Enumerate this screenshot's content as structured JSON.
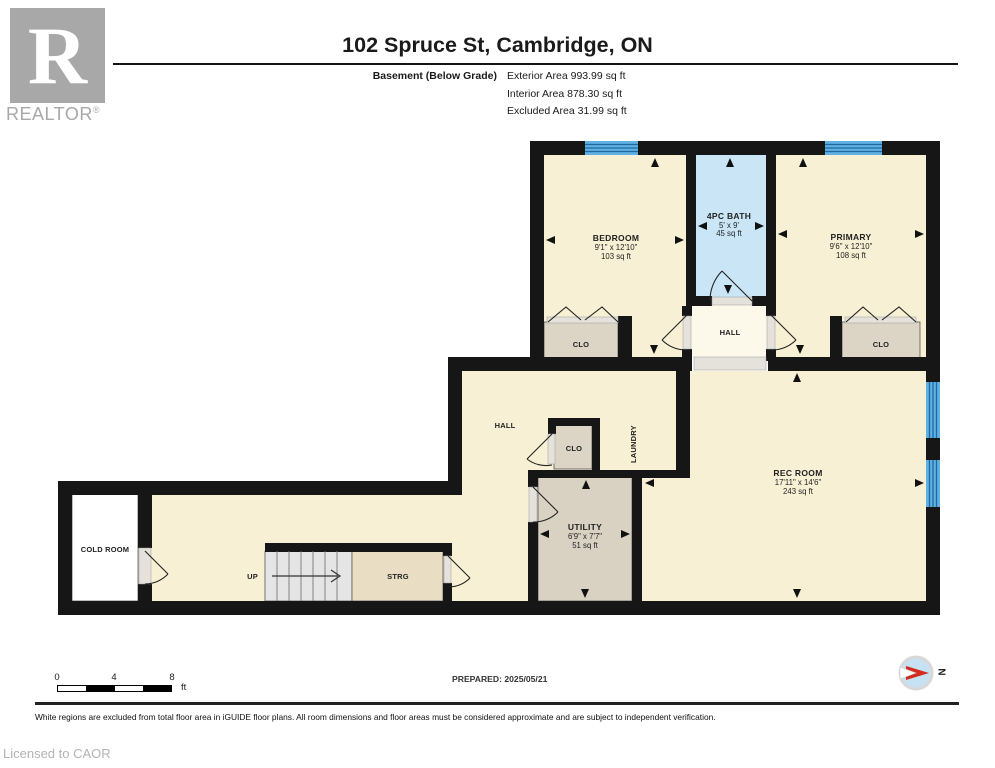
{
  "header": {
    "title": "102 Spruce St, Cambridge, ON",
    "floor_label": "Basement (Below Grade)",
    "areas": {
      "exterior": "Exterior Area 993.99 sq ft",
      "interior": "Interior Area 878.30 sq ft",
      "excluded": "Excluded Area 31.99 sq ft"
    }
  },
  "branding": {
    "logo_letter": "R",
    "realtor": "REALTOR",
    "reg": "®"
  },
  "rooms": {
    "bedroom": {
      "name": "BEDROOM",
      "dims": "9'1\" x 12'10\"",
      "area": "103 sq ft"
    },
    "bath": {
      "name": "4PC BATH",
      "dims": "5' x 9'",
      "area": "45 sq ft"
    },
    "primary": {
      "name": "PRIMARY",
      "dims": "9'6\" x 12'10\"",
      "area": "108 sq ft"
    },
    "hall_upper": {
      "name": "HALL"
    },
    "clo_bedroom": {
      "name": "CLO"
    },
    "clo_primary": {
      "name": "CLO"
    },
    "hall_lower": {
      "name": "HALL"
    },
    "clo_hall": {
      "name": "CLO"
    },
    "laundry": {
      "name": "LAUNDRY"
    },
    "utility": {
      "name": "UTILITY",
      "dims": "6'9\" x 7'7\"",
      "area": "51 sq ft"
    },
    "rec_room": {
      "name": "REC ROOM",
      "dims": "17'11\" x 14'6\"",
      "area": "243 sq ft"
    },
    "cold_room": {
      "name": "COLD ROOM"
    },
    "storage": {
      "name": "STRG"
    },
    "stairs": {
      "label": "UP"
    }
  },
  "footer": {
    "scale": {
      "t0": "0",
      "t4": "4",
      "t8": "8",
      "unit": "ft"
    },
    "prepared": "PREPARED: 2025/05/21",
    "compass_n": "N",
    "disclaimer": "White regions are excluded from total floor area in iGUIDE floor plans. All room dimensions and floor areas must be considered approximate and are subject to independent verification.",
    "licensed": "Licensed to CAOR"
  },
  "colors": {
    "floor_cream": "#f8f0d4",
    "bath_blue": "#c9e5f6",
    "window_blue": "#5fb0e3",
    "closet_grey": "#dcd5c6",
    "storage_tan": "#e9ddc4",
    "wall_black": "#161616"
  }
}
